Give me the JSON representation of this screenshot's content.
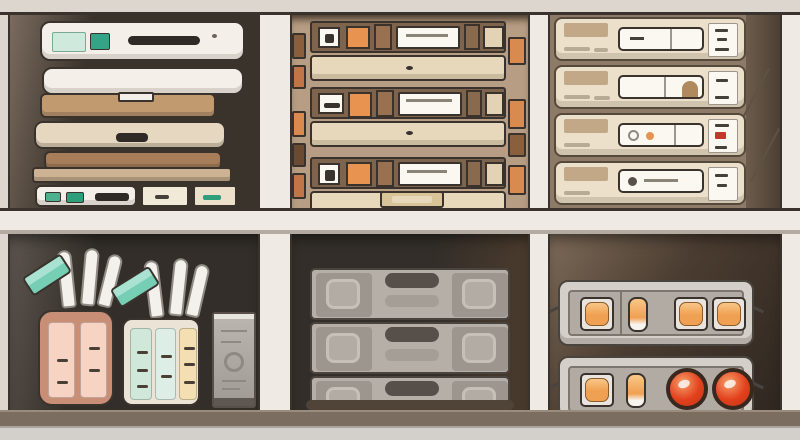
{
  "scene": {
    "description": "Stylized flat illustration of a two-row storage shelf unit with six compartments holding electronics, books, cardboard drawer organizers, storage drawers, holders, utility crates and metal equipment cases",
    "rows": 2,
    "columns": 3,
    "text_content": "none - illustration contains no legible text"
  },
  "palette": {
    "frame_light": "#ddd6cf",
    "frame_white": "#efeae3",
    "line_dark": "#3a332d",
    "shadow_mid": "#b3aba2",
    "floor_board": "#7b6e60",
    "floor_board_edge": "#9b8d7d",
    "floor_light": "#d3d0cc",
    "floor_line": "#a9a5a0",
    "c1_wall": "#7a6b5e",
    "c1_dark": "#3a332b",
    "c2_top_bg": "#b79d83",
    "c2_top_shade": "#44362a",
    "c3_top_bg": "#8d7a67",
    "c3_wedge_1": "#6d5c4c",
    "c3_wedge_2": "#4c3f33",
    "crease": "#5f5144",
    "cb_wall": "#5d554e",
    "cb_dark": "#332e29",
    "c2b_right": "#4a3b2d",
    "c3b_1": "#7d6a58",
    "c3b_2": "#4a3c30",
    "c3b_3": "#2f2720",
    "device_white": "#f4efe8",
    "mint_label": "#cfeadd",
    "mint_border": "#7aa998",
    "teal_button": "#35a486",
    "slot_dark": "#2f2a25",
    "indicator": "#6b6258",
    "book1": "#c29a70",
    "book2": "#e6d8c0",
    "book3": "#a87e5a",
    "book4": "#cdb394",
    "green1": "#4db08e",
    "green2": "#2f9e7a",
    "label_box1": "#f2ead9",
    "label_box2": "#ece0cb",
    "side_brown": "#8a5f3e",
    "side_orange": "#d98a4e",
    "side_brown2": "#6b4a32",
    "side_orange2": "#c07646",
    "cardboard_row": "#7e644c",
    "cardboard_face": "#e7d8bb",
    "plate_white": "#fbf8f2",
    "scribble": "#8a8378",
    "orange_accent": "#e89350",
    "brown_seg": "#9a7150",
    "brown_seg2": "#8a6a4c",
    "cream_seg": "#e3d3b4",
    "bottom_box": "#d9c49a",
    "box_cream": "#ece0cb",
    "box_tan": "#c3a887",
    "unit_border": "#55493c",
    "dash_light": "#b8ab96",
    "card_dash": "#44403a",
    "red_mark": "#c0392b",
    "arch_tan": "#b08a5c",
    "knob_gray": "#8f8984",
    "holder1_body": "#c98e76",
    "holder1_panel": "#f7d3c4",
    "panel_dash": "#4a3f35",
    "holder2_body": "#ebe3d6",
    "panel_mint": "#cfe8da",
    "panel_mint2": "#dceee5",
    "panel_cream": "#f3dfb2",
    "blade_white": "#f4f1ec",
    "blade_border": "#8f8a83",
    "teal_block": "#76ceb5",
    "teal_block_light": "#aae2d2",
    "tower_light": "#bcb6b0",
    "tower_dark": "#a09a94",
    "tower_border": "#57504a",
    "tower_base": "#5f5852",
    "tower_top": "#e8e4de",
    "crate_gray": "#b6afa7",
    "crate_side": "#9d968e",
    "crate_outline": "#c6c0b9",
    "crate_inner": "#b3aca4",
    "crate_handle": "#57504a",
    "crate_pill": "#a59e97",
    "crate_border": "#4a443e",
    "crate_base": "#4f4437",
    "case_outer": "#d5cfc9",
    "case_inner": "#b2aba4",
    "case_inner_border": "#7d766e",
    "case_border": "#4a443e",
    "window_frame": "#e9e4de",
    "window_orange": "#f0a052",
    "window_orange_light": "#f8c788",
    "window_border": "#8a5a28",
    "knob_red": "#e2401c",
    "knob_red_light": "#f6a06a",
    "knob_red_dark": "#c23514",
    "knob_ring": "#38281e",
    "white_stripe": "#f7f4ef"
  },
  "compartments": {
    "top_left": {
      "items": [
        "white media device with mint label, teal button and dark disc slot",
        "plain white tray",
        "stack of 4 books (tan, cream, brown, sand)",
        "small white device with two green buttons",
        "two small labeled boxes"
      ],
      "book_count": 4,
      "book_color_refs": [
        "book1",
        "book2",
        "book3",
        "book4"
      ]
    },
    "top_middle": {
      "items": [
        "three stacked cardboard drawer organizers with orange and brown blocks and white label plates",
        "narrow side stacks of brown and orange boxes",
        "small cream box at bottom"
      ],
      "unit_count": 3
    },
    "top_right": {
      "items": [
        "four stacked cream storage drawers with tan corner labels, white handle plates and small label cards",
        "third drawer has gray circle + orange dot and red card mark",
        "second drawer has tan arch detail"
      ],
      "drawer_count": 4
    },
    "bottom_left": {
      "items": [
        "salmon holder with two slotted pink panels",
        "cream holder with two mint panels and one tan panel",
        "white blade-like items and tilted teal blocks sticking out of both holders",
        "gray control tower with round knob"
      ],
      "holder_count": 2,
      "blade_count_per_holder": 3
    },
    "bottom_middle": {
      "items": [
        "three stacked gray utility crates with dark pill handles and recessed side squares",
        "dark base shadow"
      ],
      "crate_count": 3
    },
    "bottom_right": {
      "items": [
        "metal case with three framed amber windows and one amber pill light",
        "metal case with one framed amber window, one amber pill light and two round red-orange knobs"
      ],
      "case_count": 2,
      "knob_count": 2,
      "amber_window_count": 6
    }
  }
}
